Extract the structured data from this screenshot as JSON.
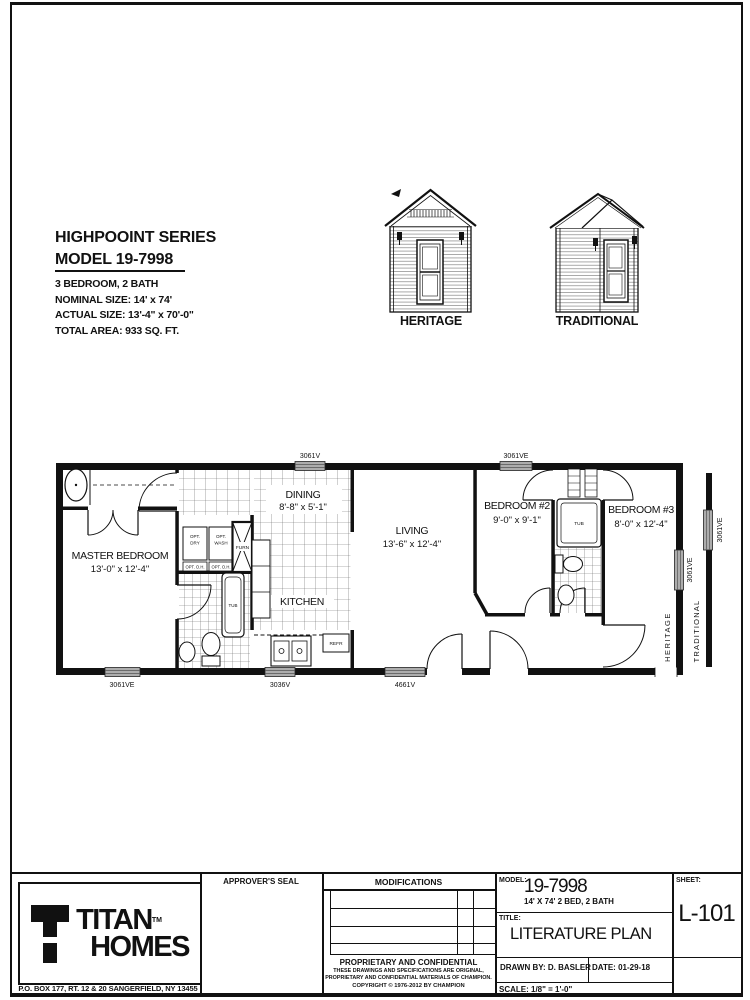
{
  "colors": {
    "ink": "#111111",
    "paper": "#ffffff"
  },
  "info": {
    "series": "HIGHPOOINT SERIES",
    "model": "MODEL 19-7998",
    "specs": [
      "3 BEDROOM, 2 BATH",
      "NOMINAL SIZE: 14' x 74'",
      "ACTUAL SIZE:  13'-4\" x 70'-0\"",
      "TOTAL AREA: 933 SQ. FT."
    ]
  },
  "elevations": {
    "heritage_label": "HERITAGE",
    "traditional_label": "TRADITIONAL"
  },
  "plan": {
    "rooms": {
      "master": {
        "name": "MASTER BEDROOM",
        "dims": "13'-0\" x 12'-4\""
      },
      "dining": {
        "name": "DINING",
        "dims": "8'-8\" x 5'-1\""
      },
      "kitchen": {
        "name": "KITCHEN"
      },
      "living": {
        "name": "LIVING",
        "dims": "13'-6\" x 12'-4\""
      },
      "bedroom2": {
        "name": "BEDROOM #2",
        "dims": "9'-0\" x 9'-1\""
      },
      "bedroom3": {
        "name": "BEDROOM #3",
        "dims": "8'-0\" x 12'-4\""
      }
    },
    "fixtures": {
      "opt_dry1": "OPT.",
      "opt_dry2": "DRY",
      "opt_oh_a": "OPT. O.H.",
      "opt_wash1": "OPT.",
      "opt_wash2": "WASH",
      "opt_oh_b": "OPT. O.H.",
      "furn": "FURN",
      "tub_master": "TUB",
      "tub_bath": "TUB",
      "refr": "REFR"
    },
    "windows": {
      "top_dining": "3061V",
      "top_bed2": "3061VE",
      "bot_master": "3061VE",
      "bot_kitchen": "3036V",
      "bot_living": "4661V",
      "right_main": "3061VE",
      "right_alt": "3061VE"
    },
    "wall_labels": {
      "heritage": "HERITAGE",
      "traditional": "TRADITIONAL"
    }
  },
  "title_block": {
    "approvers_seal": "APPROVER'S SEAL",
    "modifications": "MODIFICATIONS",
    "proprietary": {
      "heading": "PROPRIETARY AND CONFIDENTIAL",
      "line1": "THESE DRAWINGS AND SPECIFICATIONS ARE ORIGINAL,",
      "line2": "PROPRIETARY AND CONFIDENTIAL MATERIALS OF CHAMPION.",
      "copyright": "COPYRIGHT © 1976-2012 BY CHAMPION"
    },
    "model_label": "MODEL:",
    "model_value": "19-7998",
    "model_sub": "14' X 74' 2 BED, 2 BATH",
    "title_label": "TITLE:",
    "title_value": "LITERATURE PLAN",
    "sheet_label": "SHEET:",
    "sheet_value": "L-101",
    "drawn_by": "DRAWN BY: D. BASLER",
    "date": "DATE: 01-29-18",
    "scale": "SCALE: 1/8\" = 1'-0\""
  },
  "logo": {
    "name_top": "TITAN",
    "tm": "TM",
    "name_bottom": "HOMES",
    "address": "P.O. BOX 177, RT. 12 & 20 SANGERFIELD, NY  13455"
  }
}
